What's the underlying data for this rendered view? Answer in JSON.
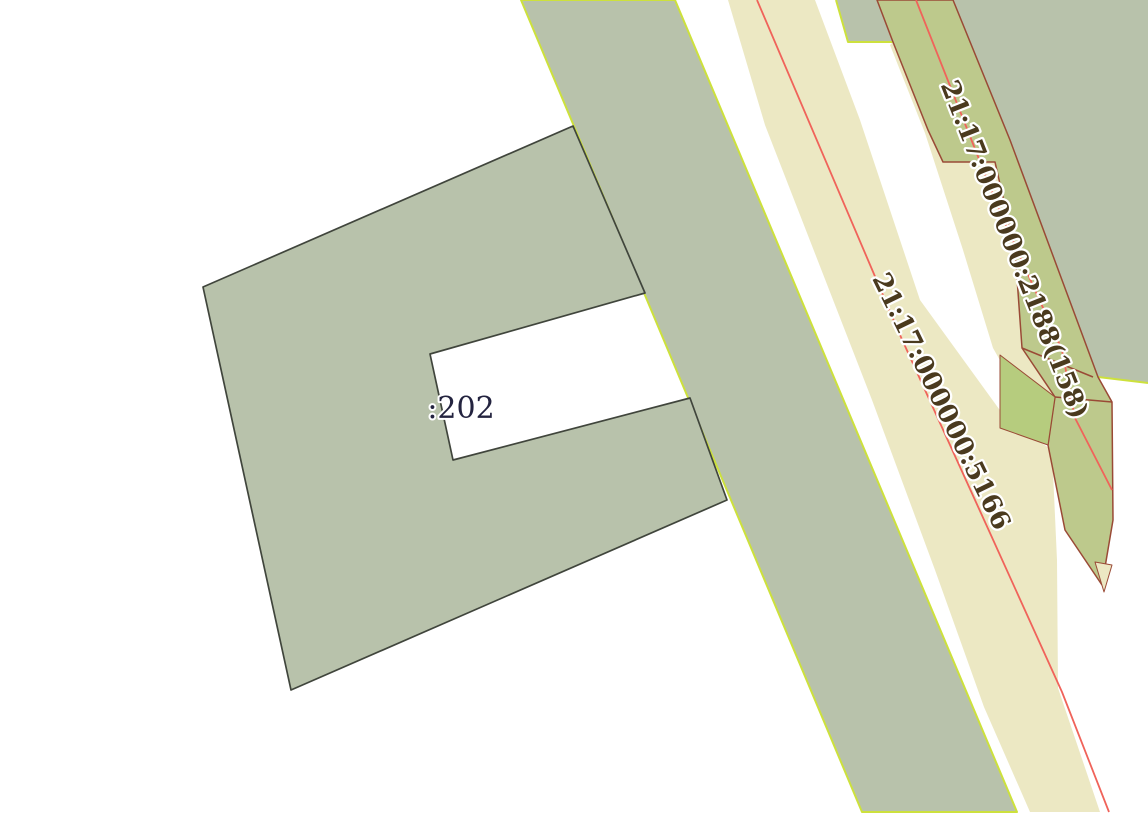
{
  "canvas": {
    "width": 1148,
    "height": 820
  },
  "map": {
    "colors": {
      "background": "#ffffff",
      "parcel_gray_green": "#b8c2ab",
      "road_cream": "#ece8c3",
      "road_olive": "#bdc98c",
      "olive_bright": "#b6cc7e",
      "chartreuse_border": "#cde13c",
      "brown_border": "#9a4a36",
      "red_line": "#f0635a",
      "dark_border": "#40453c",
      "label_navy": "#23233f",
      "label_brown": "#4a3a1e",
      "halo": "#ffffff"
    },
    "shapes": [
      {
        "name": "band-gray-main",
        "type": "polygon",
        "interactable": true,
        "fill": "parcel_gray_green",
        "stroke": "chartreuse_border",
        "stroke_width": 2,
        "points": [
          [
            521,
            0
          ],
          [
            675,
            0
          ],
          [
            1017,
            812
          ],
          [
            862,
            812
          ]
        ]
      },
      {
        "name": "region-gray-topright",
        "type": "polygon",
        "interactable": true,
        "fill": "parcel_gray_green",
        "stroke": null,
        "stroke_width": 0,
        "points": [
          [
            953,
            0
          ],
          [
            1148,
            0
          ],
          [
            1148,
            383
          ],
          [
            1098,
            377
          ],
          [
            1010,
            140
          ]
        ]
      },
      {
        "name": "edge-chartreuse-topright",
        "type": "polyline",
        "interactable": false,
        "fill": null,
        "stroke": "chartreuse_border",
        "stroke_width": 2,
        "points": [
          [
            1098,
            377
          ],
          [
            1148,
            383
          ]
        ]
      },
      {
        "name": "parcel-gray-top-notch",
        "type": "polygon",
        "interactable": true,
        "fill": "parcel_gray_green",
        "stroke": null,
        "stroke_width": 0,
        "points": [
          [
            836,
            0
          ],
          [
            877,
            0
          ],
          [
            893,
            42
          ],
          [
            848,
            42
          ]
        ]
      },
      {
        "name": "edge-chartreuse-top-notch",
        "type": "polyline",
        "interactable": false,
        "fill": null,
        "stroke": "chartreuse_border",
        "stroke_width": 2,
        "points": [
          [
            836,
            0
          ],
          [
            848,
            42
          ],
          [
            893,
            42
          ]
        ]
      },
      {
        "name": "road-cream-5166",
        "type": "polygon",
        "interactable": true,
        "fill": "road_cream",
        "stroke": null,
        "stroke_width": 0,
        "points": [
          [
            728,
            0
          ],
          [
            815,
            0
          ],
          [
            860,
            120
          ],
          [
            920,
            300
          ],
          [
            1007,
            420
          ],
          [
            1052,
            450
          ],
          [
            1057,
            560
          ],
          [
            1058,
            688
          ],
          [
            1100,
            812
          ],
          [
            1030,
            812
          ],
          [
            984,
            707
          ],
          [
            935,
            570
          ],
          [
            872,
            400
          ],
          [
            765,
            125
          ]
        ]
      },
      {
        "name": "strip-cream-along-olive",
        "type": "polygon",
        "interactable": true,
        "fill": "road_cream",
        "stroke": null,
        "stroke_width": 0,
        "points": [
          [
            890,
            45
          ],
          [
            893,
            42
          ],
          [
            928,
            130
          ],
          [
            943,
            162
          ],
          [
            995,
            162
          ],
          [
            1015,
            250
          ],
          [
            1022,
            348
          ],
          [
            1055,
            397
          ],
          [
            1048,
            445
          ],
          [
            993,
            348
          ],
          [
            963,
            250
          ],
          [
            925,
            133
          ]
        ]
      },
      {
        "name": "road-olive-2188",
        "type": "polygon",
        "interactable": true,
        "fill": "road_olive",
        "stroke": "brown_border",
        "stroke_width": 1.5,
        "points": [
          [
            877,
            0
          ],
          [
            893,
            42
          ],
          [
            928,
            130
          ],
          [
            943,
            162
          ],
          [
            995,
            162
          ],
          [
            1015,
            250
          ],
          [
            1022,
            348
          ],
          [
            1055,
            397
          ],
          [
            1048,
            445
          ],
          [
            1065,
            530
          ],
          [
            1102,
            585
          ],
          [
            1113,
            520
          ],
          [
            1112,
            402
          ],
          [
            1098,
            377
          ],
          [
            1010,
            140
          ],
          [
            953,
            0
          ]
        ]
      },
      {
        "name": "subparcel-olive-bright",
        "type": "polygon",
        "interactable": true,
        "fill": "olive_bright",
        "stroke": "brown_border",
        "stroke_width": 1,
        "points": [
          [
            1000,
            355
          ],
          [
            1055,
            397
          ],
          [
            1048,
            445
          ],
          [
            1000,
            428
          ]
        ]
      },
      {
        "name": "boundary-brown-sub1",
        "type": "polyline",
        "interactable": false,
        "fill": null,
        "stroke": "brown_border",
        "stroke_width": 1.5,
        "points": [
          [
            1022,
            348
          ],
          [
            1093,
            377
          ]
        ]
      },
      {
        "name": "boundary-brown-sub2",
        "type": "polyline",
        "interactable": false,
        "fill": null,
        "stroke": "brown_border",
        "stroke_width": 1.5,
        "points": [
          [
            1055,
            397
          ],
          [
            1112,
            402
          ]
        ]
      },
      {
        "name": "sliver-cream-tip",
        "type": "polygon",
        "interactable": true,
        "fill": "road_cream",
        "stroke": "brown_border",
        "stroke_width": 1,
        "points": [
          [
            1095,
            562
          ],
          [
            1112,
            565
          ],
          [
            1104,
            592
          ]
        ]
      },
      {
        "name": "centerline-red-5166",
        "type": "polyline",
        "interactable": false,
        "fill": null,
        "stroke": "red_line",
        "stroke_width": 1.8,
        "points": [
          [
            757,
            0
          ],
          [
            900,
            335
          ],
          [
            990,
            533
          ],
          [
            1062,
            692
          ],
          [
            1109,
            812
          ]
        ]
      },
      {
        "name": "centerline-red-2188",
        "type": "polyline",
        "interactable": false,
        "fill": null,
        "stroke": "red_line",
        "stroke_width": 1.8,
        "points": [
          [
            916,
            0
          ],
          [
            1000,
            212
          ],
          [
            1062,
            350
          ],
          [
            1075,
            418
          ],
          [
            1112,
            490
          ]
        ]
      },
      {
        "name": "parcel-202",
        "type": "polygon",
        "interactable": true,
        "fill": "parcel_gray_green",
        "stroke": "dark_border",
        "stroke_width": 1.7,
        "points": [
          [
            573,
            126
          ],
          [
            645,
            293
          ],
          [
            430,
            354
          ],
          [
            453,
            460
          ],
          [
            690,
            398
          ],
          [
            727,
            500
          ],
          [
            291,
            690
          ],
          [
            203,
            287
          ]
        ]
      }
    ],
    "labels": [
      {
        "name": "parcel-label-202",
        "text": ":202",
        "x": 461,
        "y": 410,
        "rotation": 0,
        "font_size": 30,
        "bold": false,
        "color": "label_navy",
        "halo_width": 4
      },
      {
        "name": "parcel-label-5166",
        "text": "21:17:000000:5166",
        "x": 940,
        "y": 402,
        "rotation": 64,
        "font_size": 26,
        "bold": true,
        "color": "label_brown",
        "halo_width": 4.5
      },
      {
        "name": "parcel-label-2188",
        "text": "21:17:000000:2188(158)",
        "x": 1013,
        "y": 250,
        "rotation": 68.5,
        "font_size": 26,
        "bold": true,
        "color": "label_brown",
        "halo_width": 4.5
      }
    ]
  }
}
